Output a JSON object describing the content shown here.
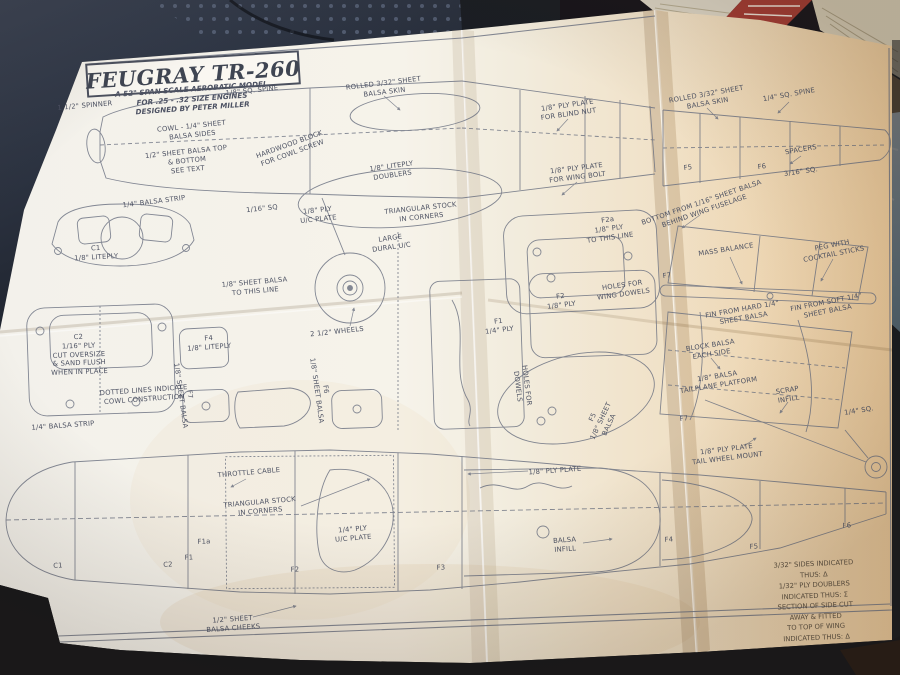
{
  "plan": {
    "title": "FEUGRAY TR-260",
    "subtitle": "A 52\" SPAN SCALE AEROBATIC MODEL\nFOR .25 - .32 SIZE ENGINES\nDESIGNED BY PETER MILLER",
    "notes": "3/32\" SIDES INDICATED THUS: Δ\n1/32\" PLY DOUBLERS INDICATED THUS: Σ\nSECTION OF SIDE CUT AWAY & FITTED\nTO TOP OF WING INDICATED THUS: Δ",
    "labels": [
      "1 1/2\" SPINNER",
      "COWL - 1/4\" SHEET\nBALSA SIDES",
      "1/2\" SHEET BALSA TOP\n& BOTTOM\nSEE TEXT",
      "1/8\" SQ. SPINE",
      "ROLLED 3/32\" SHEET\nBALSA SKIN",
      "HARDWOOD BLOCK\nFOR COWL SCREW",
      "1/8\" LITEPLY\nDOUBLERS",
      "1/8\" PLY PLATE\nFOR BLIND NUT",
      "ROLLED 3/32\" SHEET\nBALSA SKIN",
      "1/4\" SQ. SPINE",
      "SPACERS",
      "F5",
      "F6",
      "3/16\" SQ.",
      "1/8\" PLY PLATE\nFOR WING BOLT",
      "TRIANGULAR STOCK\nIN CORNERS",
      "1/8\" PLY\nU/C PLATE",
      "1/16\" SQ",
      "LARGE\nDURAL U/C",
      "1/8\" SHEET BALSA\nTO THIS LINE",
      "F2a\n1/8\" PLY\nTO THIS LINE",
      "HOLES FOR\nWING DOWELS",
      "F2\n1/8\" PLY",
      "F7",
      "2 1/2\" WHEELS",
      "F1\n1/4\" PLY",
      "BOTTOM FROM 1/16\" SHEET BALSA\nBEHIND WING FUSELAGE",
      "MASS BALANCE",
      "PEG WITH\nCOCKTAIL STICKS",
      "FIN FROM HARD 1/4\"\nSHEET BALSA",
      "FIN FROM SOFT 1/4\"\nSHEET BALSA",
      "BLOCK BALSA\nEACH SIDE",
      "1/8\" BALSA\nTAILPLANE PLATFORM",
      "SCRAP\nINFILL",
      "1/4\" SQ.",
      "F7",
      "1/8\" PLY PLATE\nTAIL WHEEL MOUNT",
      "1/8\" PLY PLATE",
      "BALSA\nINFILL",
      "F4",
      "F5",
      "F6",
      "THROTTLE CABLE",
      "TRIANGULAR STOCK\nIN CORNERS",
      "1/4\" PLY\nU/C PLATE",
      "F1a",
      "F1",
      "F2",
      "F3",
      "C1",
      "C2",
      "1/2\" SHEET\nBALSA CHEEKS",
      "C2\n1/16\" PLY\nCUT OVERSIZE\n& SAND FLUSH\nWHEN IN PLACE",
      "DOTTED LINES INDICATE\nCOWL CONSTRUCTION",
      "1/4\" BALSA STRIP",
      "C1\n1/8\" LITEPLY",
      "F4\n1/8\" LITEPLY",
      "F7\n1/8\" SHEET BALSA",
      "F6\n1/8\" SHEET BALSA",
      "HOLES FOR\nDOWELS",
      "F5\n1/8\" SHEET\nBALSA",
      "1/4\" BALSA STRIP"
    ],
    "colors": {
      "background": "#1a1d23",
      "paper": "#f5f2ea",
      "paper_warm": "#eed8b6",
      "ink": "#6a7080",
      "book_red": "#a03a32",
      "fabric_navy": "#333c4e",
      "magazine_blue": "#bcd6e4"
    }
  }
}
